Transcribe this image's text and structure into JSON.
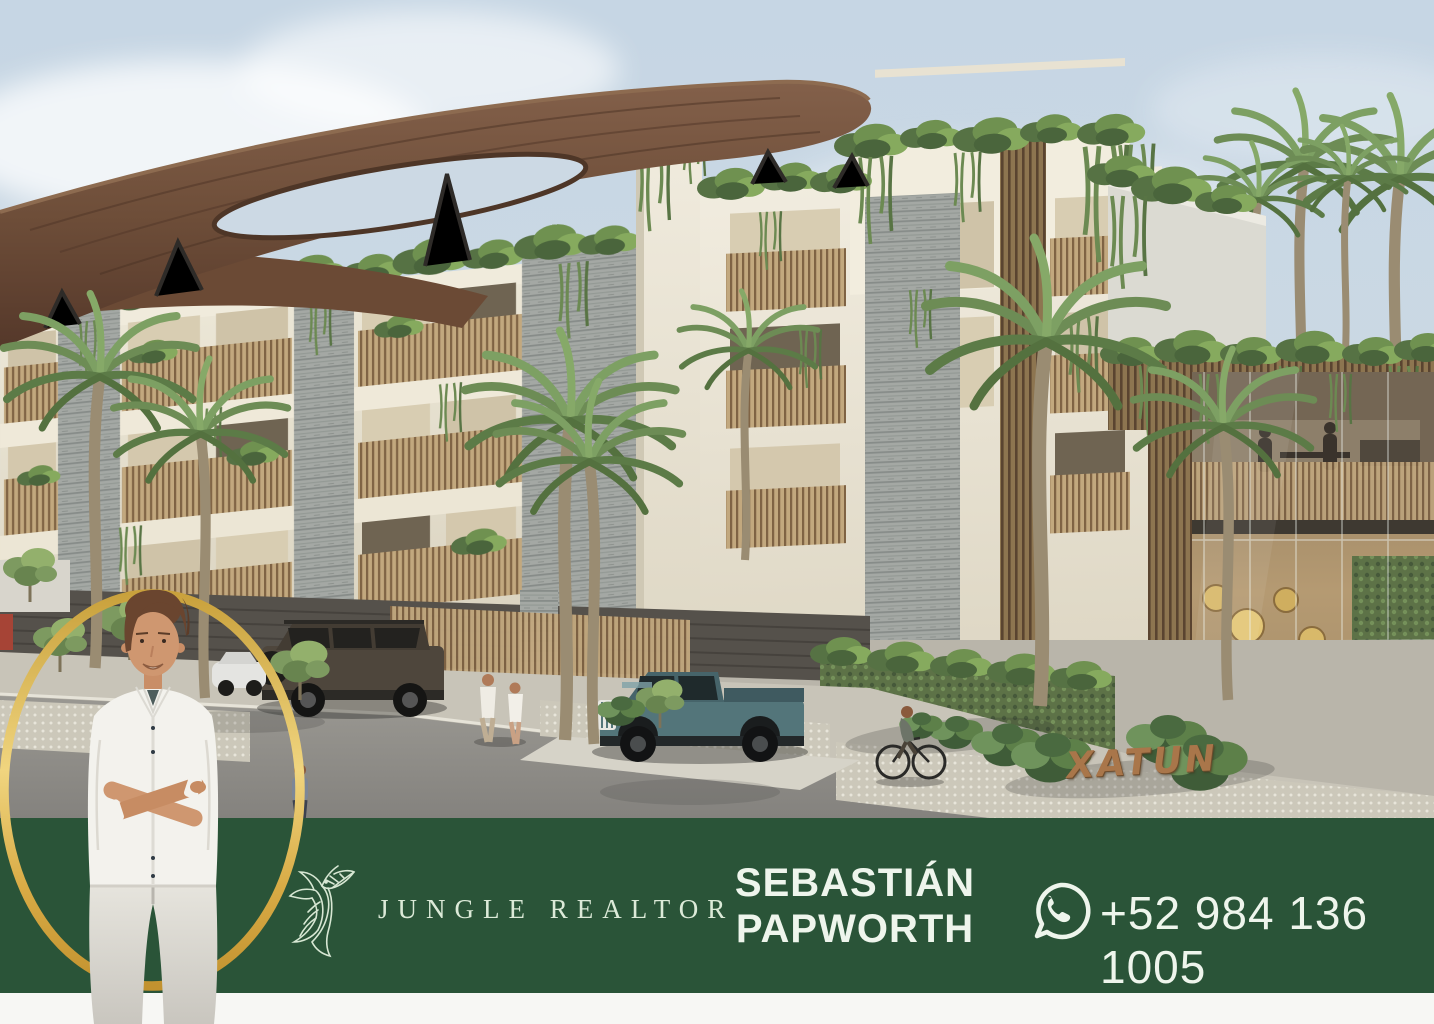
{
  "brand": {
    "name": "JUNGLE REALTOR",
    "logo_icon": "hummingbird-logo"
  },
  "agent": {
    "name_line1": "SEBASTIÁN",
    "name_line2": "PAPWORTH"
  },
  "contact": {
    "phone": "+52 984 136 1005",
    "icon": "whatsapp-icon"
  },
  "property": {
    "sign_text": "XATUN"
  },
  "colors": {
    "banner_green": "#2a5438",
    "gold": "#d9a73e",
    "text_light": "#eef5ec",
    "sky": "#c9d8e4",
    "canopy_brown": "#6b4a35"
  }
}
